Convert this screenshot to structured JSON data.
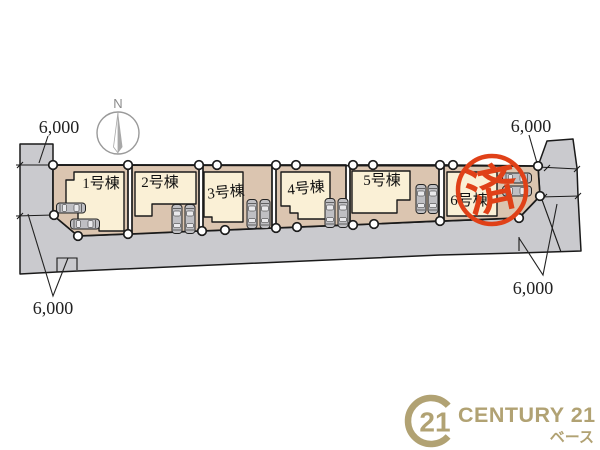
{
  "plan": {
    "compass": {
      "label": "N"
    },
    "lots": [
      {
        "label": "1号棟"
      },
      {
        "label": "2号棟"
      },
      {
        "label": "3号棟"
      },
      {
        "label": "4号棟"
      },
      {
        "label": "5号棟"
      },
      {
        "label": "6号棟"
      }
    ],
    "stamp": {
      "text": "済",
      "color": "#e04118"
    },
    "dimensions": {
      "top_left": "6,000",
      "top_right": "6,000",
      "bottom_left": "6,000",
      "bottom_right": "6,000"
    },
    "colors": {
      "road": "#cacace",
      "parcel": "#dbc5b0",
      "building": "#faf0d6",
      "outline": "#1a1a1a",
      "stamp_red": "#e04118",
      "logo_gold": "#b1a273"
    }
  },
  "footer": {
    "seal_number": "21",
    "brand": "CENTURY 21",
    "sub_brand": "ベース",
    "color": "#b1a273"
  }
}
